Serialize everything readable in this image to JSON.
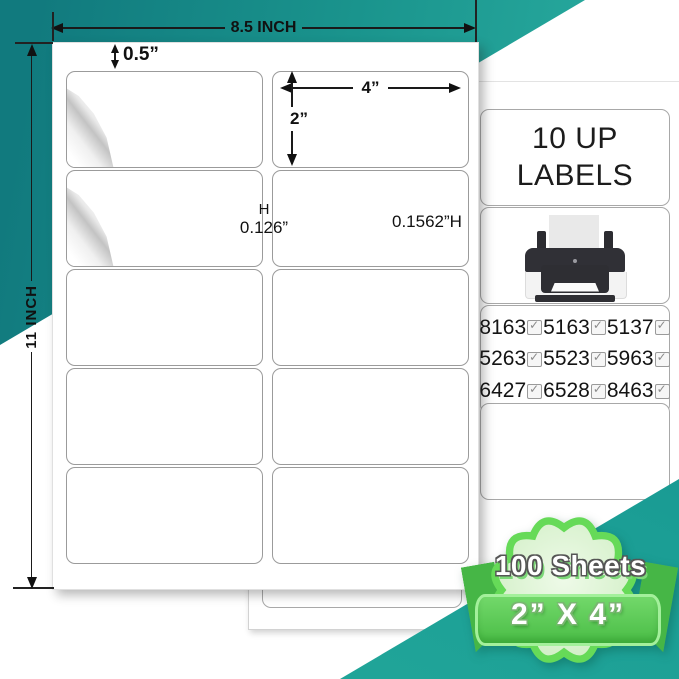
{
  "dimensions": {
    "sheet_width": "8.5 INCH",
    "sheet_height": "11 INCH",
    "top_margin": "0.5”",
    "label_width": "4”",
    "label_height": "2”",
    "col_gap_letter": "H",
    "col_gap": "0.126”",
    "row_gap": "0.1562”H"
  },
  "panel": {
    "title_line1": "10 UP",
    "title_line2": "LABELS",
    "compat": [
      [
        "8163",
        "5163",
        "5137"
      ],
      [
        "5263",
        "5523",
        "5963"
      ],
      [
        "6427",
        "6528",
        "8463"
      ]
    ]
  },
  "badge": {
    "sheet_count": "100 Sheets",
    "label_size": "2” X 4”"
  },
  "colors": {
    "teal_dark": "#117a7e",
    "teal_light": "#2bafa2",
    "badge_border_green": "#5fd954",
    "ribbon_green": "#4abd46",
    "badge_fill_green": "#d7f1cb",
    "text_black": "#111111"
  }
}
